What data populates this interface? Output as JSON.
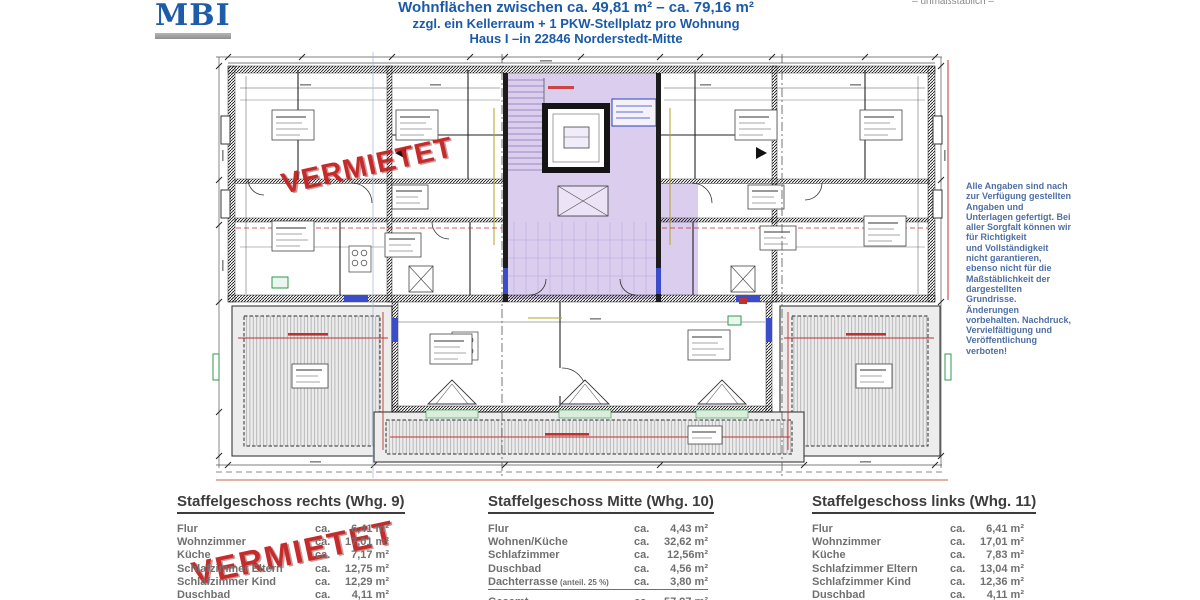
{
  "header": {
    "logo": "MBI",
    "scale_note": "– unmaßstäblich –",
    "title_line1": "Wohnflächen zwischen ca. 49,81 m² – ca. 79,16 m²",
    "title_line2": "zzgl. ein Kellerraum + 1 PKW-Stellplatz pro Wohnung",
    "title_line3": "Haus I –in 22846 Norderstedt-Mitte"
  },
  "stamps": {
    "plan": "VERMIETET",
    "tables": "VERMIETET"
  },
  "disclaimer_lines": [
    "Alle Angaben sind nach",
    "zur Verfügung gestellten",
    "Angaben und",
    "Unterlagen gefertigt. Bei",
    "aller Sorgfalt können wir",
    "für Richtigkeit",
    "und Vollständigkeit",
    "nicht garantieren,",
    "ebenso nicht für die",
    "Maßstäblichkeit der",
    "dargestellten",
    "Grundrisse.",
    "Änderungen",
    "vorbehalten. Nachdruck,",
    "Vervielfältigung und",
    "Veröffentlichung",
    "verboten!"
  ],
  "area_prefix": "ca.",
  "tables": [
    {
      "title": "Staffelgeschoss rechts (Whg. 9)",
      "rows": [
        {
          "label": "Flur",
          "value": "6,41 m²"
        },
        {
          "label": "Wohnzimmer",
          "value": "17,01 m²"
        },
        {
          "label": "Küche",
          "value": "7,17 m²"
        },
        {
          "label": "Schlafzimmer Eltern",
          "value": "12,75 m²"
        },
        {
          "label": "Schlafzimmer Kind",
          "value": "12,29 m²"
        },
        {
          "label": "Duschbad",
          "value": "4,11 m²"
        },
        {
          "label": "Abstell",
          "value": "4,41 m²"
        }
      ]
    },
    {
      "title": "Staffelgeschoss Mitte (Whg. 10)",
      "rows": [
        {
          "label": "Flur",
          "value": "4,43 m²"
        },
        {
          "label": "Wohnen/Küche",
          "value": "32,62 m²"
        },
        {
          "label": "Schlafzimmer",
          "value": "12,56m²"
        },
        {
          "label": "Duschbad",
          "value": "4,56 m²"
        },
        {
          "label": "Dachterrasse",
          "note": "(anteil. 25 %)",
          "value": "3,80 m²",
          "underline": true
        },
        {
          "label": "Gesamt",
          "value": "57,97 m²",
          "total": true
        }
      ]
    },
    {
      "title": "Staffelgeschoss links (Whg. 11)",
      "rows": [
        {
          "label": "Flur",
          "value": "6,41 m²"
        },
        {
          "label": "Wohnzimmer",
          "value": "17,01 m²"
        },
        {
          "label": "Küche",
          "value": "7,83 m²"
        },
        {
          "label": "Schlafzimmer Eltern",
          "value": "13,04 m²"
        },
        {
          "label": "Schlafzimmer Kind",
          "value": "12,36 m²"
        },
        {
          "label": "Duschbad",
          "value": "4,11 m²"
        },
        {
          "label": "Abstell",
          "value": "1,36 m²"
        }
      ]
    }
  ],
  "colors": {
    "title_blue": "#1b5aa8",
    "logo_blue": "#1d5ca8",
    "stamp_red": "#c42020",
    "disclaimer_blue": "#4e6fa6",
    "table_gray": "#707070",
    "core_purple": "#dacdee",
    "dimension_red": "#c03030",
    "window_blue": "#3a4cc9",
    "marker_green": "#2f9a4d"
  }
}
